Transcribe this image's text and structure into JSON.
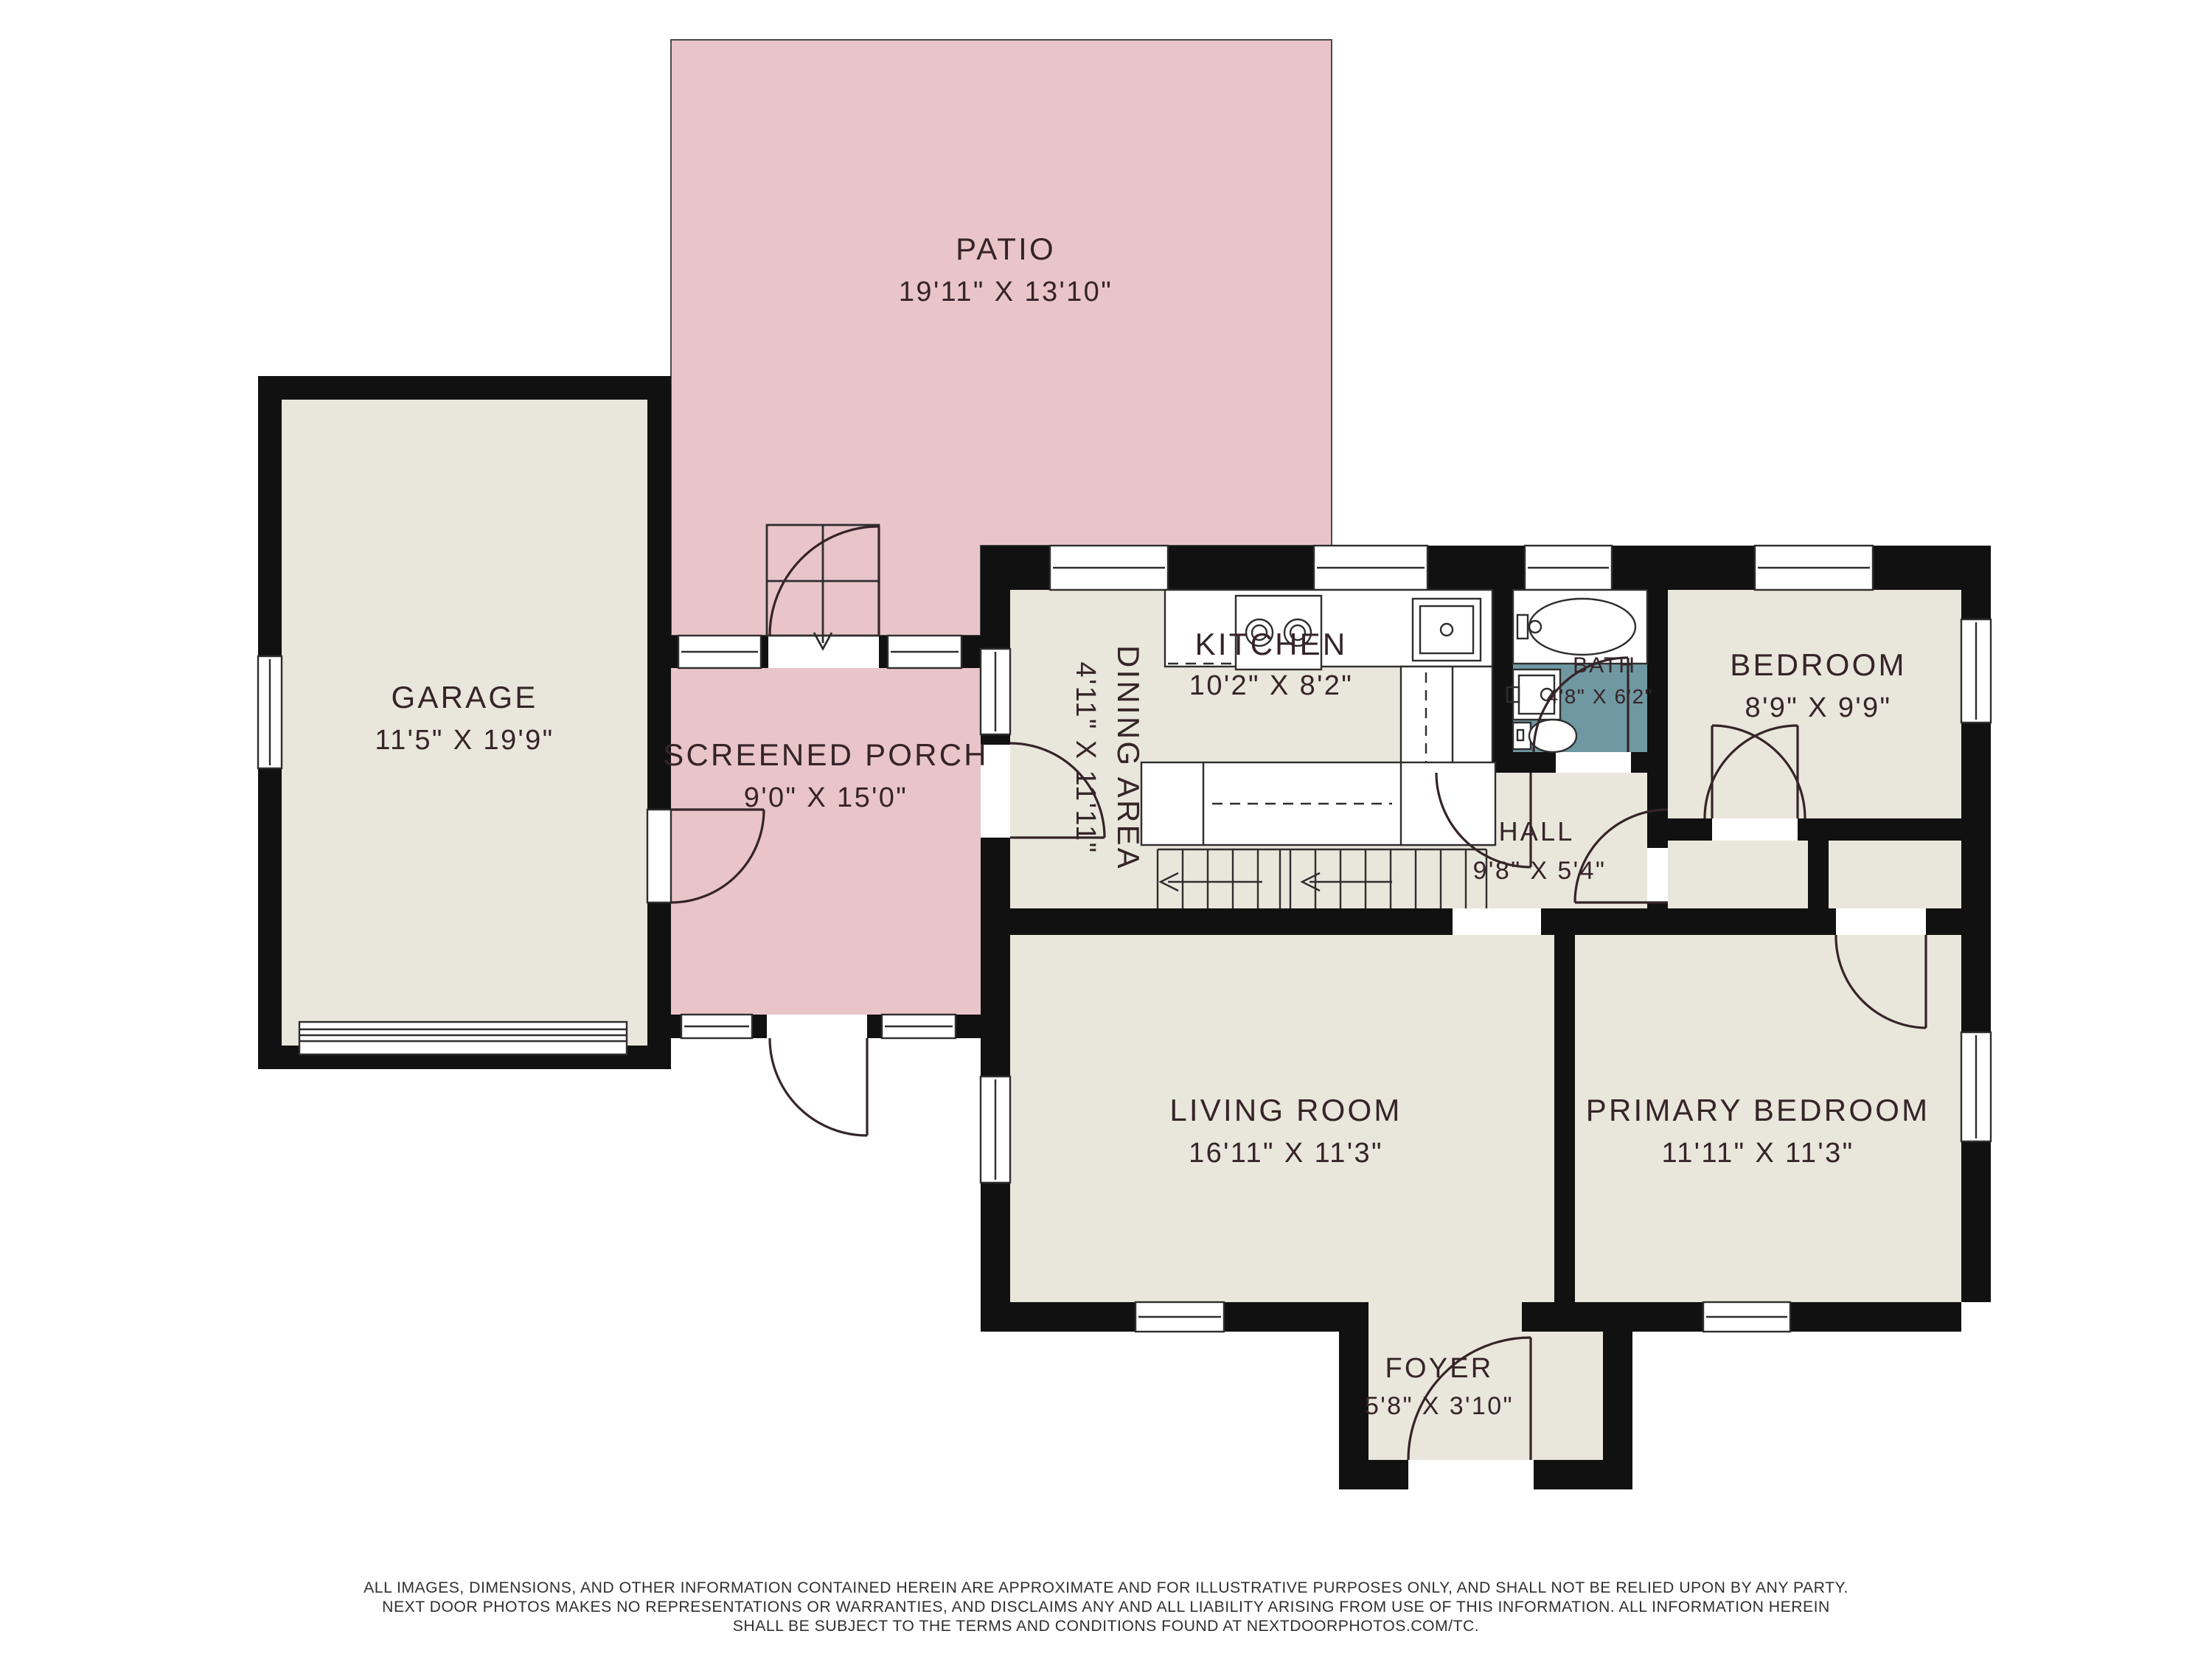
{
  "rooms": [
    {
      "name": "PATIO",
      "dims": "19'11\" X 13'10\""
    },
    {
      "name": "GARAGE",
      "dims": "11'5\" X 19'9\""
    },
    {
      "name": "SCREENED PORCH",
      "dims": "9'0\" X 15'0\""
    },
    {
      "name": "KITCHEN",
      "dims": "10'2\" X 8'2\""
    },
    {
      "name": "DINING AREA",
      "dims": "4'11\" X 11'11\""
    },
    {
      "name": "BATH",
      "dims": "4'8\" X 6'2\""
    },
    {
      "name": "BEDROOM",
      "dims": "8'9\" X 9'9\""
    },
    {
      "name": "HALL",
      "dims": "9'8\" X 5'4\""
    },
    {
      "name": "LIVING ROOM",
      "dims": "16'11\" X 11'3\""
    },
    {
      "name": "PRIMARY BEDROOM",
      "dims": "11'11\" X 11'3\""
    },
    {
      "name": "FOYER",
      "dims": "5'8\" X 3'10\""
    }
  ],
  "disclaimer": {
    "line1": "ALL IMAGES, DIMENSIONS, AND OTHER INFORMATION CONTAINED HEREIN ARE APPROXIMATE AND FOR ILLUSTRATIVE PURPOSES ONLY, AND SHALL NOT BE RELIED UPON BY ANY PARTY.",
    "line2": "NEXT DOOR PHOTOS MAKES NO REPRESENTATIONS OR WARRANTIES, AND DISCLAIMS ANY AND ALL LIABILITY ARISING FROM USE OF THIS INFORMATION. ALL INFORMATION HEREIN",
    "line3": "SHALL BE SUBJECT TO THE TERMS AND CONDITIONS FOUND AT NEXTDOORPHOTOS.COM/TC."
  },
  "colors": {
    "wall": "#111111",
    "floor": "#e9e6db",
    "outdoor_pink": "#e9c5c9",
    "bath_teal": "#6f98a2",
    "label_text": "#352428"
  }
}
